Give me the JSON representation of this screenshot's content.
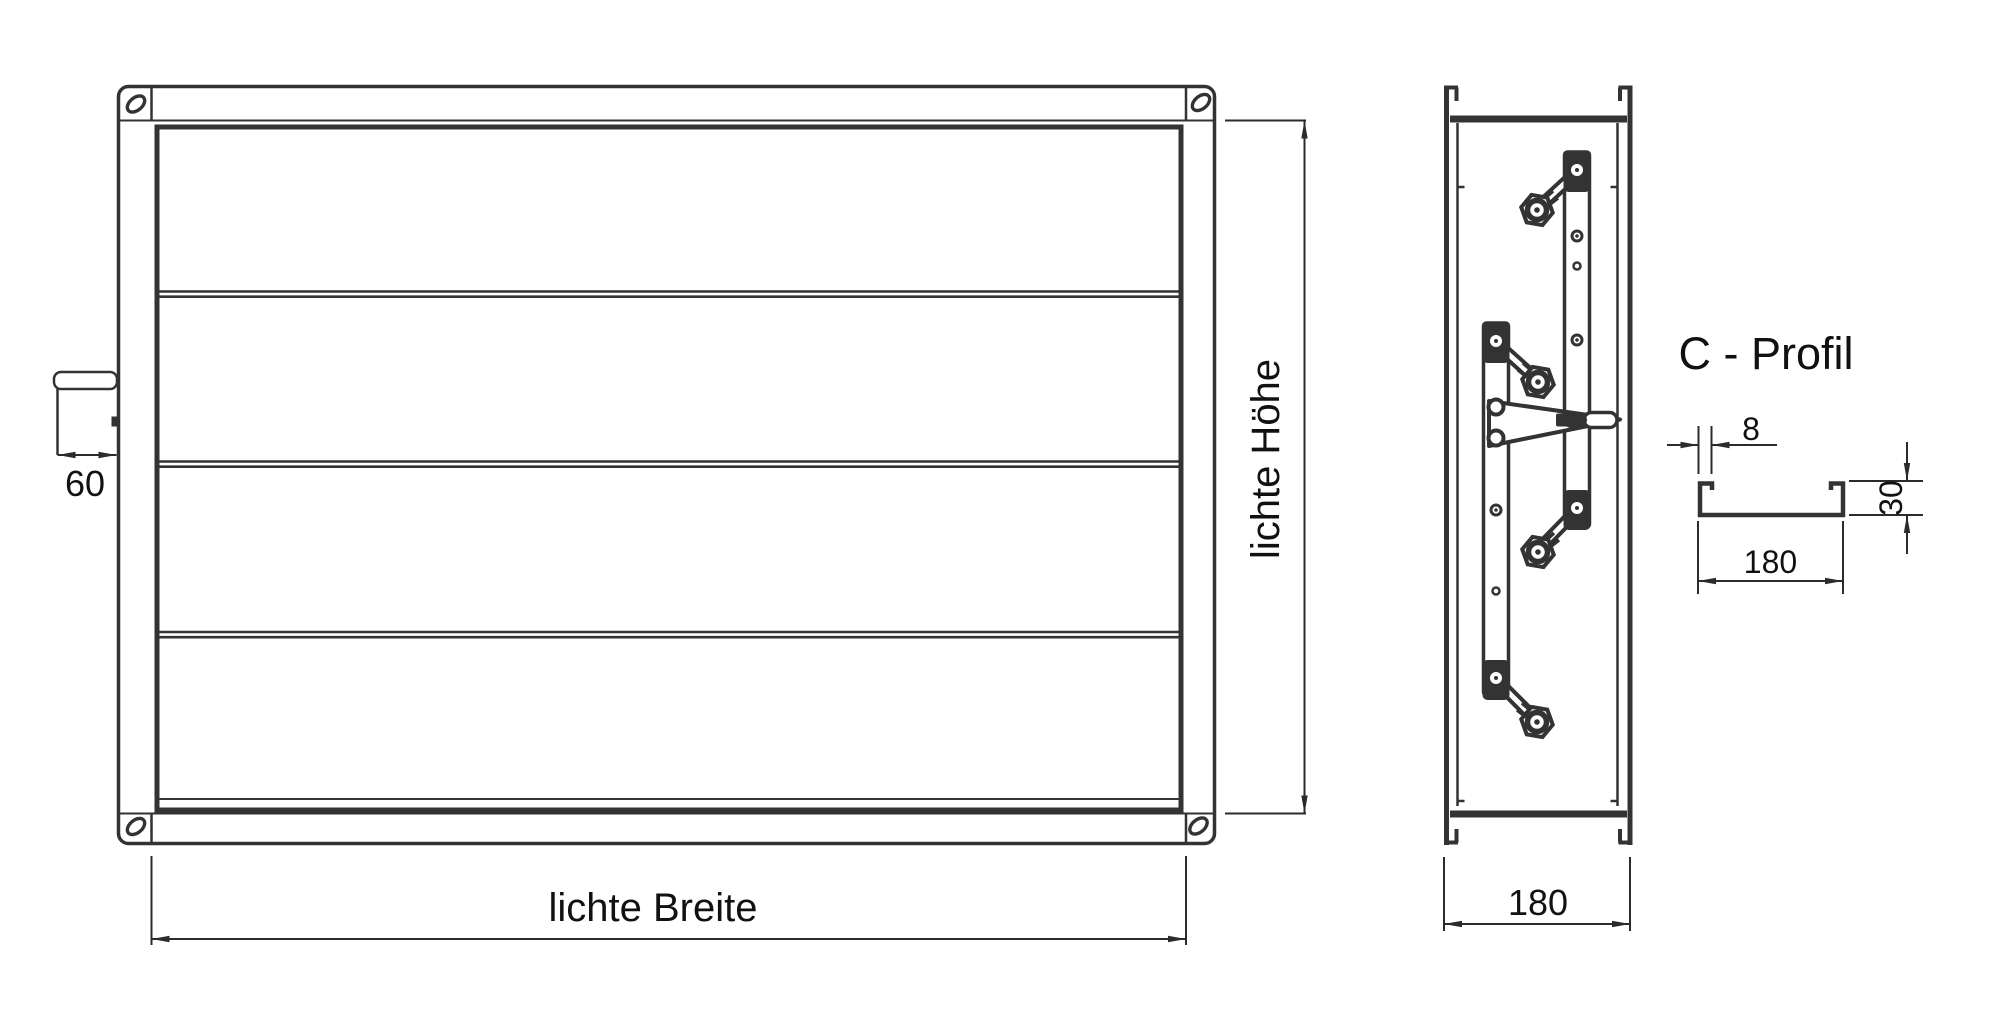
{
  "meta": {
    "type": "technical-drawing",
    "subject": "louver damper with C-profile frame",
    "background_color": "#ffffff",
    "line_color": "#333333",
    "text_color": "#111111"
  },
  "front_view": {
    "width_label": "lichte Breite",
    "height_label": "lichte Höhe",
    "shaft_dim": "60",
    "blade_count": 4,
    "corner_hole_count": 4
  },
  "side_view": {
    "depth_dim": "180",
    "blade_pivot_count": 4
  },
  "c_profile": {
    "title": "C - Profil",
    "thickness_dim": "8",
    "flange_dim": "30",
    "width_dim": "180"
  }
}
